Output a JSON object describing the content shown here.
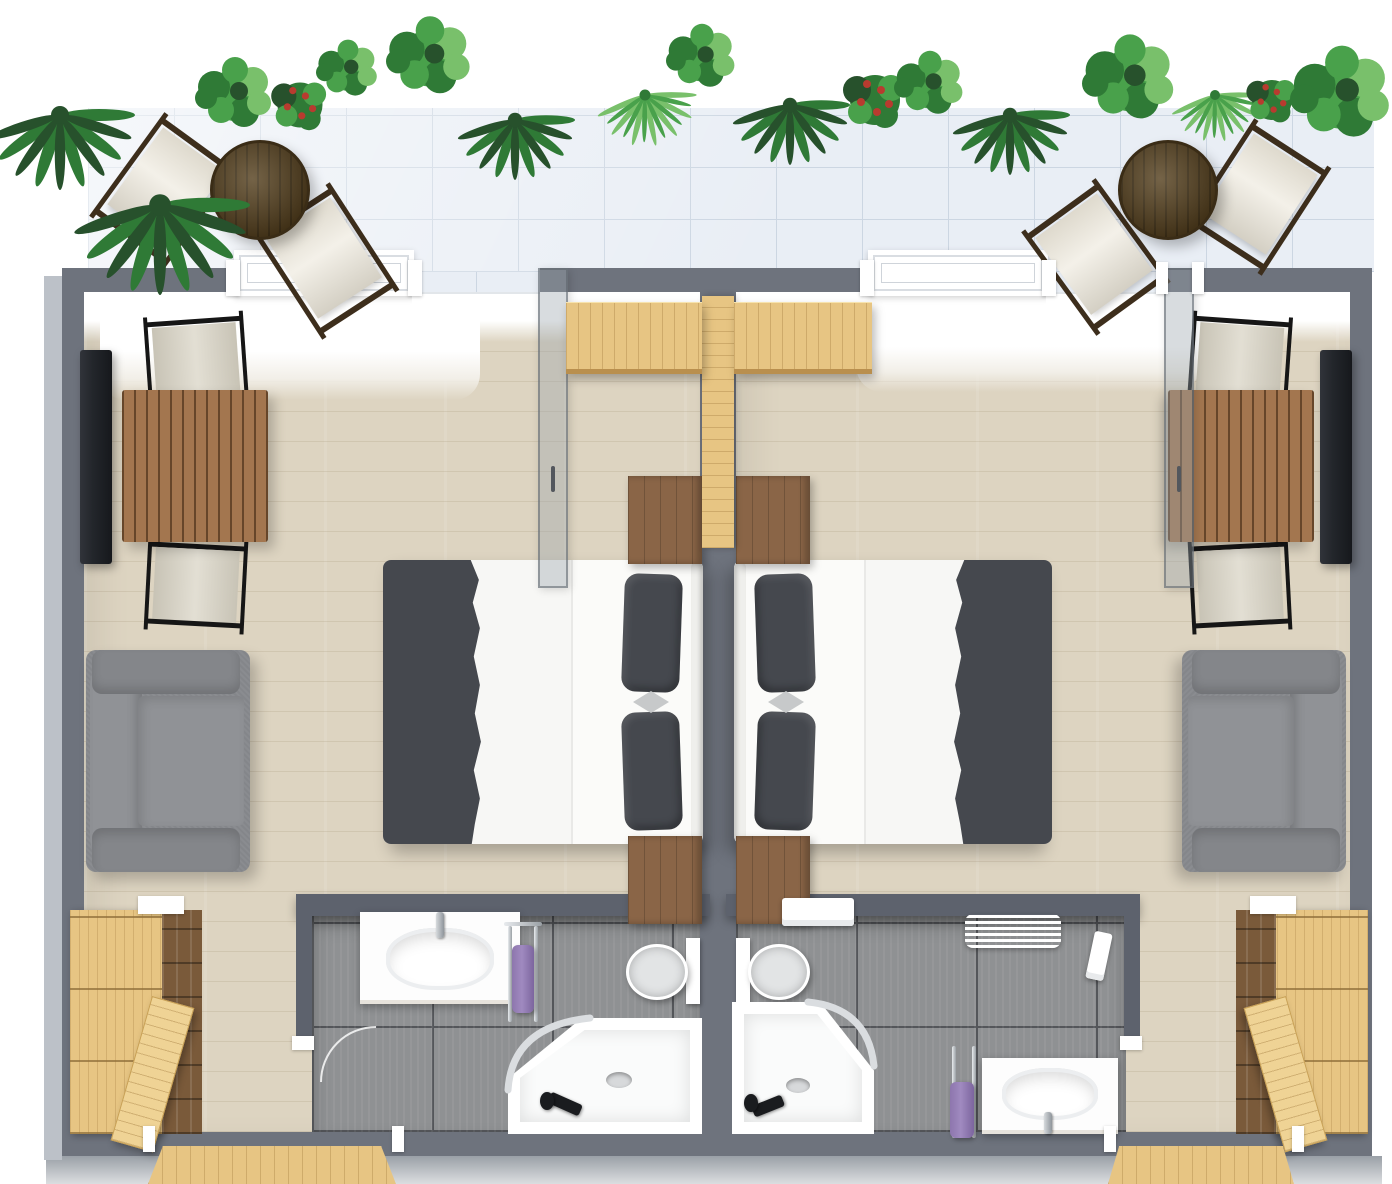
{
  "scene": {
    "type": "3d-floorplan-top-down-render",
    "rooms": [
      {
        "id": "left-unit",
        "contents": [
          "balcony-access",
          "dining-table-with-2-chairs",
          "wall-tv",
          "double-bed",
          "2-nightstands",
          "gray-sofa",
          "wooden-sliding-door",
          "glass-door",
          "wardrobe",
          "bathroom"
        ]
      },
      {
        "id": "right-unit",
        "contents": [
          "balcony-access",
          "dining-table-with-2-chairs",
          "wall-tv",
          "double-bed",
          "2-nightstands",
          "gray-sofa",
          "wooden-sliding-door",
          "glass-door",
          "wardrobe",
          "bathroom"
        ]
      }
    ],
    "bathroom_left": [
      "vanity-sink",
      "towel-stand-purple-towel",
      "toilet",
      "corner-shower",
      "door-arc"
    ],
    "bathroom_right": [
      "wall-shelf",
      "towel-radiator",
      "toilet",
      "corner-shower",
      "towel-stand-purple-towel",
      "vanity-sink"
    ]
  },
  "palette": {
    "paper": "#ffffff",
    "wall": "#6e737d",
    "wall_dark": "#5d626d",
    "wall_light": "#bcc1c8",
    "base": "#9aa0a7",
    "floor": "#ddd4c1",
    "tile": "#e9eef5",
    "tile_grout": "#ccd6e2",
    "bath_tile": "#8f9193",
    "bath_grout": "#54565a",
    "wood_light": "#e7c583",
    "wood_mid": "#a3764f",
    "wood_dark": "#56411f",
    "wood_night": "#8a6547",
    "wood_shelf": "#7a5a3a",
    "sofa": "#84868a",
    "sofa_light": "#909296",
    "bed_white": "#f7f7f5",
    "bed_dark": "#45484e",
    "canvas": "#ece7da",
    "canvas2": "#d9d4c5",
    "tv": "#23262b",
    "glass": "rgba(152,162,170,0.38)",
    "purple": "#a08ac0",
    "green1": "#2f7a36",
    "green2": "#49a14b",
    "green3": "#79c06b",
    "green_dark": "#27512c",
    "red": "#b83b2f"
  },
  "balcony": {
    "plants": [
      {
        "x": 60,
        "y": 115,
        "s": 1.5,
        "v": "palm"
      },
      {
        "x": 160,
        "y": 205,
        "s": 1.8,
        "v": "palm"
      },
      {
        "x": 235,
        "y": 95,
        "s": 1.0,
        "v": "bush"
      },
      {
        "x": 300,
        "y": 105,
        "s": 0.9,
        "v": "red"
      },
      {
        "x": 348,
        "y": 70,
        "s": 0.8,
        "v": "bush"
      },
      {
        "x": 430,
        "y": 58,
        "s": 1.1,
        "v": "bush"
      },
      {
        "x": 515,
        "y": 120,
        "s": 1.2,
        "v": "palm"
      },
      {
        "x": 645,
        "y": 95,
        "s": 1.1,
        "v": "fern"
      },
      {
        "x": 702,
        "y": 58,
        "s": 0.9,
        "v": "bush"
      },
      {
        "x": 790,
        "y": 105,
        "s": 1.2,
        "v": "palm"
      },
      {
        "x": 875,
        "y": 100,
        "s": 1.0,
        "v": "red"
      },
      {
        "x": 930,
        "y": 85,
        "s": 0.9,
        "v": "bush"
      },
      {
        "x": 1010,
        "y": 115,
        "s": 1.2,
        "v": "palm"
      },
      {
        "x": 1130,
        "y": 80,
        "s": 1.2,
        "v": "bush"
      },
      {
        "x": 1215,
        "y": 95,
        "s": 1.0,
        "v": "fern"
      },
      {
        "x": 1272,
        "y": 100,
        "s": 0.8,
        "v": "red"
      },
      {
        "x": 1342,
        "y": 95,
        "s": 1.3,
        "v": "bush"
      }
    ],
    "sets": [
      {
        "table": {
          "x": 210,
          "y": 140,
          "d": 100
        },
        "chairs": [
          {
            "x": 118,
            "y": 127,
            "w": 92,
            "h": 128,
            "rot": 36
          },
          {
            "x": 280,
            "y": 197,
            "w": 92,
            "h": 128,
            "rot": -33
          }
        ]
      },
      {
        "table": {
          "x": 1118,
          "y": 140,
          "d": 100
        },
        "chairs": [
          {
            "x": 1050,
            "y": 193,
            "w": 92,
            "h": 128,
            "rot": -36
          },
          {
            "x": 1212,
            "y": 133,
            "w": 92,
            "h": 128,
            "rot": 33
          }
        ]
      }
    ]
  },
  "furniture": {
    "nightstands": [
      {
        "x": 628,
        "y": 476,
        "w": 74,
        "h": 88
      },
      {
        "x": 628,
        "y": 836,
        "w": 74,
        "h": 88
      },
      {
        "x": 736,
        "y": 476,
        "w": 74,
        "h": 88
      },
      {
        "x": 736,
        "y": 836,
        "w": 74,
        "h": 88
      }
    ],
    "stubs": [
      {
        "x": 226,
        "y": 260,
        "w": 14,
        "h": 36
      },
      {
        "x": 408,
        "y": 260,
        "w": 14,
        "h": 36
      },
      {
        "x": 860,
        "y": 260,
        "w": 14,
        "h": 36
      },
      {
        "x": 1042,
        "y": 260,
        "w": 14,
        "h": 36
      },
      {
        "x": 1156,
        "y": 262,
        "w": 12,
        "h": 32
      },
      {
        "x": 1192,
        "y": 262,
        "w": 12,
        "h": 32
      },
      {
        "x": 138,
        "y": 896,
        "w": 46,
        "h": 18
      },
      {
        "x": 1250,
        "y": 896,
        "w": 46,
        "h": 18
      },
      {
        "x": 292,
        "y": 1036,
        "w": 22,
        "h": 14
      },
      {
        "x": 1120,
        "y": 1036,
        "w": 22,
        "h": 14
      },
      {
        "x": 143,
        "y": 1126,
        "w": 12,
        "h": 26
      },
      {
        "x": 392,
        "y": 1126,
        "w": 12,
        "h": 26
      },
      {
        "x": 1104,
        "y": 1126,
        "w": 12,
        "h": 26
      },
      {
        "x": 1292,
        "y": 1126,
        "w": 12,
        "h": 26
      }
    ]
  }
}
